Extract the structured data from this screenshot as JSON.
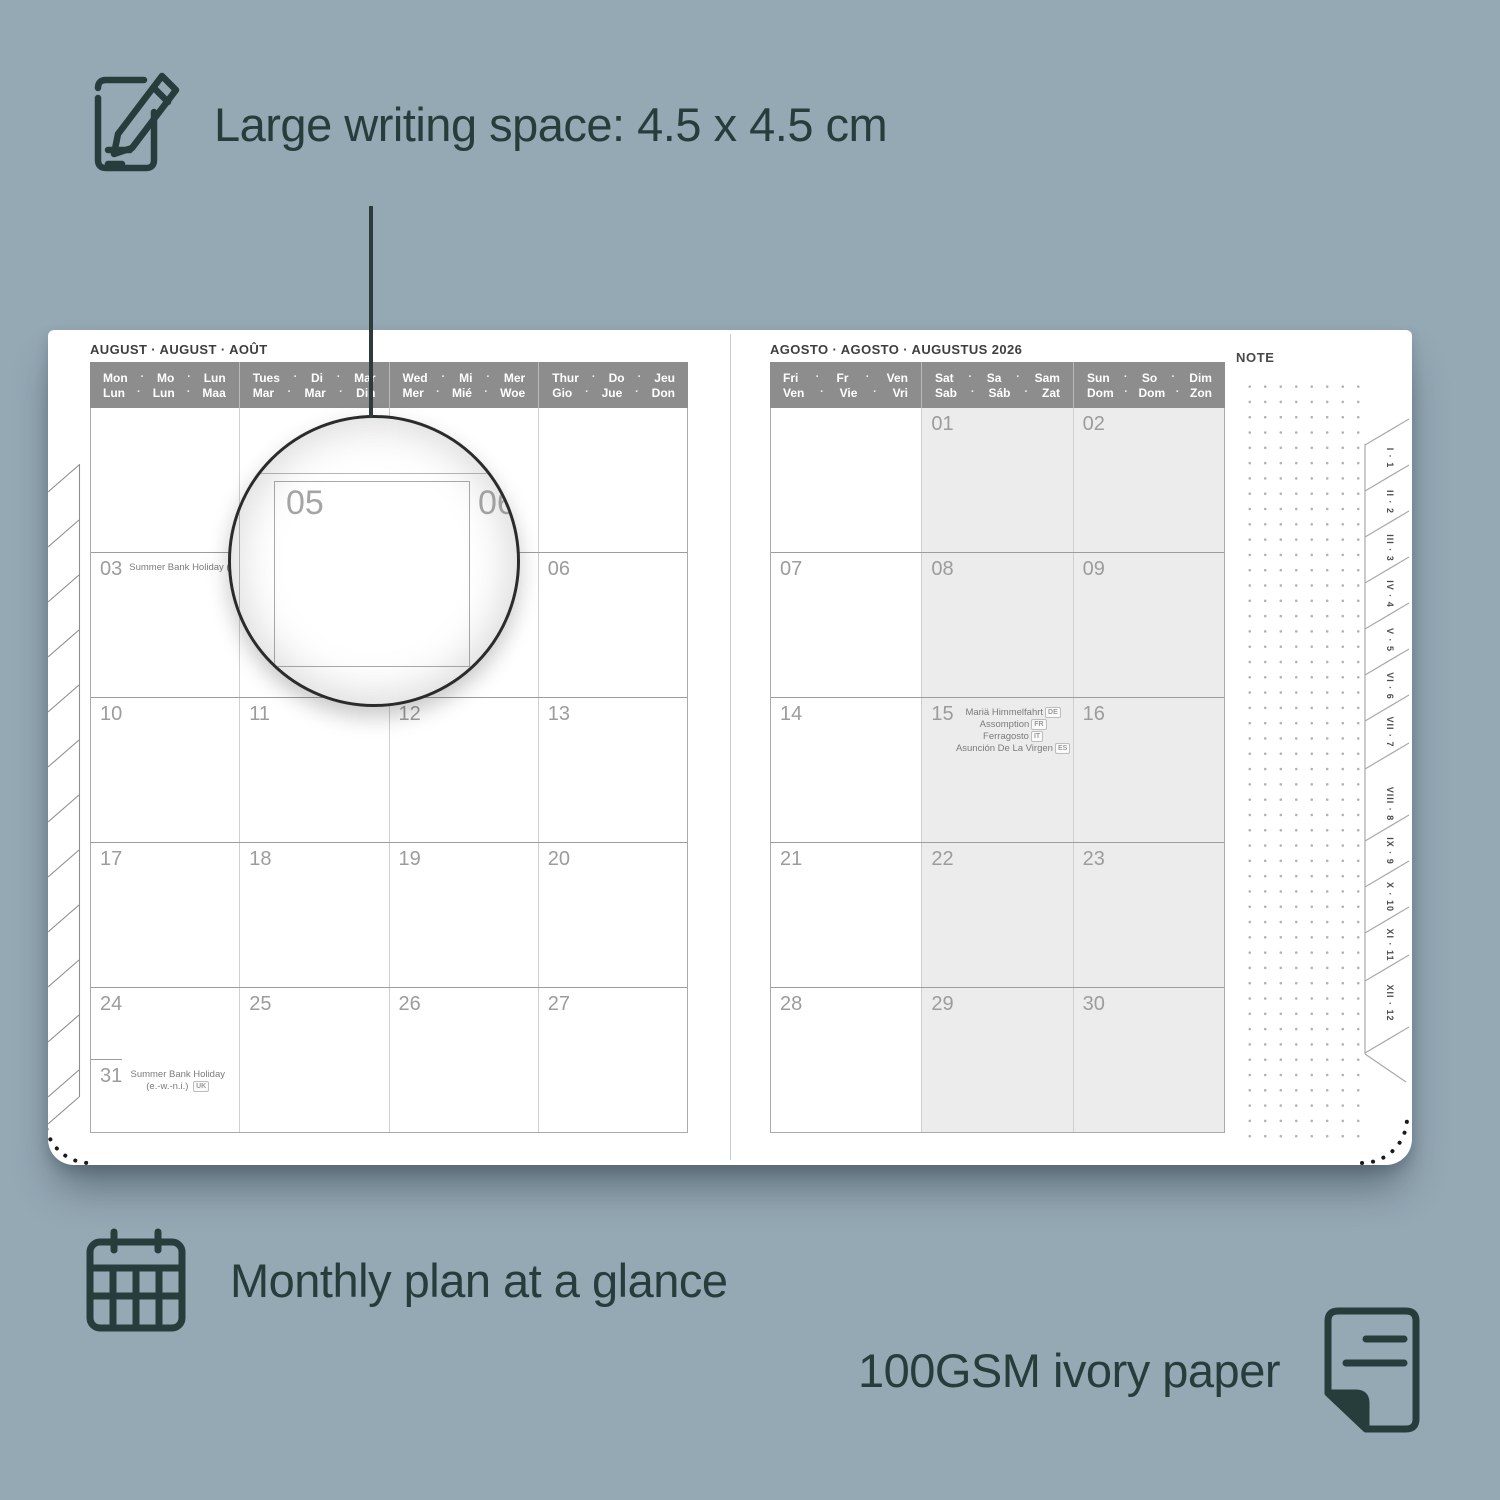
{
  "glyphs": {
    "dot": "·"
  },
  "colors": {
    "background": "#95a9b5",
    "ink": "#273d3c",
    "header_bar": "#8d8d8d",
    "weekend_fill": "#ececec",
    "date_text": "#9c9c9c",
    "page": "#ffffff"
  },
  "annotations": {
    "writing_space": {
      "icon": "pencil-note-icon",
      "text": "Large writing space: 4.5 x 4.5 cm"
    },
    "monthly": {
      "icon": "calendar-grid-icon",
      "text": "Monthly plan at a glance"
    },
    "paper": {
      "icon": "paper-sheet-icon",
      "text": "100GSM ivory paper"
    }
  },
  "magnifier": {
    "date_left": "05",
    "date_right": "06"
  },
  "left_page": {
    "title": "AUGUST · AUGUST · AOÛT",
    "day_headers": [
      {
        "top": [
          "Mon",
          "Mo",
          "Lun"
        ],
        "bottom": [
          "Lun",
          "Lun",
          "Maa"
        ]
      },
      {
        "top": [
          "Tues",
          "Di",
          "Mar"
        ],
        "bottom": [
          "Mar",
          "Mar",
          "Din"
        ]
      },
      {
        "top": [
          "Wed",
          "Mi",
          "Mer"
        ],
        "bottom": [
          "Mer",
          "Mié",
          "Woe"
        ]
      },
      {
        "top": [
          "Thur",
          "Do",
          "Jeu"
        ],
        "bottom": [
          "Gio",
          "Jue",
          "Don"
        ]
      }
    ],
    "rows": [
      {
        "cells": [
          {
            "date": ""
          },
          {
            "date": ""
          },
          {
            "date": ""
          },
          {
            "date": ""
          }
        ]
      },
      {
        "cells": [
          {
            "date": "03",
            "holidays": [
              {
                "text": "Summer Bank Holiday (sc.)",
                "badge": "UK"
              }
            ]
          },
          {
            "date": "04"
          },
          {
            "date": "05"
          },
          {
            "date": "06"
          }
        ]
      },
      {
        "cells": [
          {
            "date": "10"
          },
          {
            "date": "11"
          },
          {
            "date": "12"
          },
          {
            "date": "13"
          }
        ]
      },
      {
        "cells": [
          {
            "date": "17"
          },
          {
            "date": "18"
          },
          {
            "date": "19"
          },
          {
            "date": "20"
          }
        ]
      },
      {
        "cells": [
          {
            "date": "24",
            "split": {
              "date": "31",
              "holiday": "Summer Bank Holiday (e.-w.-n.i.)",
              "badge": "UK"
            }
          },
          {
            "date": "25"
          },
          {
            "date": "26"
          },
          {
            "date": "27"
          }
        ]
      }
    ]
  },
  "right_page": {
    "title": "AGOSTO · AGOSTO · AUGUSTUS 2026",
    "day_headers": [
      {
        "top": [
          "Fri",
          "Fr",
          "Ven"
        ],
        "bottom": [
          "Ven",
          "Vie",
          "Vri"
        ]
      },
      {
        "top": [
          "Sat",
          "Sa",
          "Sam"
        ],
        "bottom": [
          "Sab",
          "Sáb",
          "Zat"
        ]
      },
      {
        "top": [
          "Sun",
          "So",
          "Dim"
        ],
        "bottom": [
          "Dom",
          "Dom",
          "Zon"
        ]
      }
    ],
    "rows": [
      {
        "cells": [
          {
            "date": ""
          },
          {
            "date": "01"
          },
          {
            "date": "02"
          }
        ]
      },
      {
        "cells": [
          {
            "date": "07"
          },
          {
            "date": "08"
          },
          {
            "date": "09"
          }
        ]
      },
      {
        "cells": [
          {
            "date": "14"
          },
          {
            "date": "15",
            "holidays": [
              {
                "text": "Mariä Himmelfahrt",
                "badge": "DE"
              },
              {
                "text": "Assomption",
                "badge": "FR"
              },
              {
                "text": "Ferragosto",
                "badge": "IT"
              },
              {
                "text": "Asunción De La Virgen",
                "badge": "ES"
              }
            ]
          },
          {
            "date": "16"
          }
        ]
      },
      {
        "cells": [
          {
            "date": "21"
          },
          {
            "date": "22"
          },
          {
            "date": "23"
          }
        ]
      },
      {
        "cells": [
          {
            "date": "28"
          },
          {
            "date": "29"
          },
          {
            "date": "30"
          }
        ]
      }
    ]
  },
  "note_panel": {
    "label": "NOTE"
  },
  "month_tabs": [
    "I · 1",
    "II · 2",
    "III · 3",
    "IV · 4",
    "V · 5",
    "VI · 6",
    "VII · 7",
    "VIII · 8",
    "IX · 9",
    "X · 10",
    "XI · 11",
    "XII · 12"
  ]
}
